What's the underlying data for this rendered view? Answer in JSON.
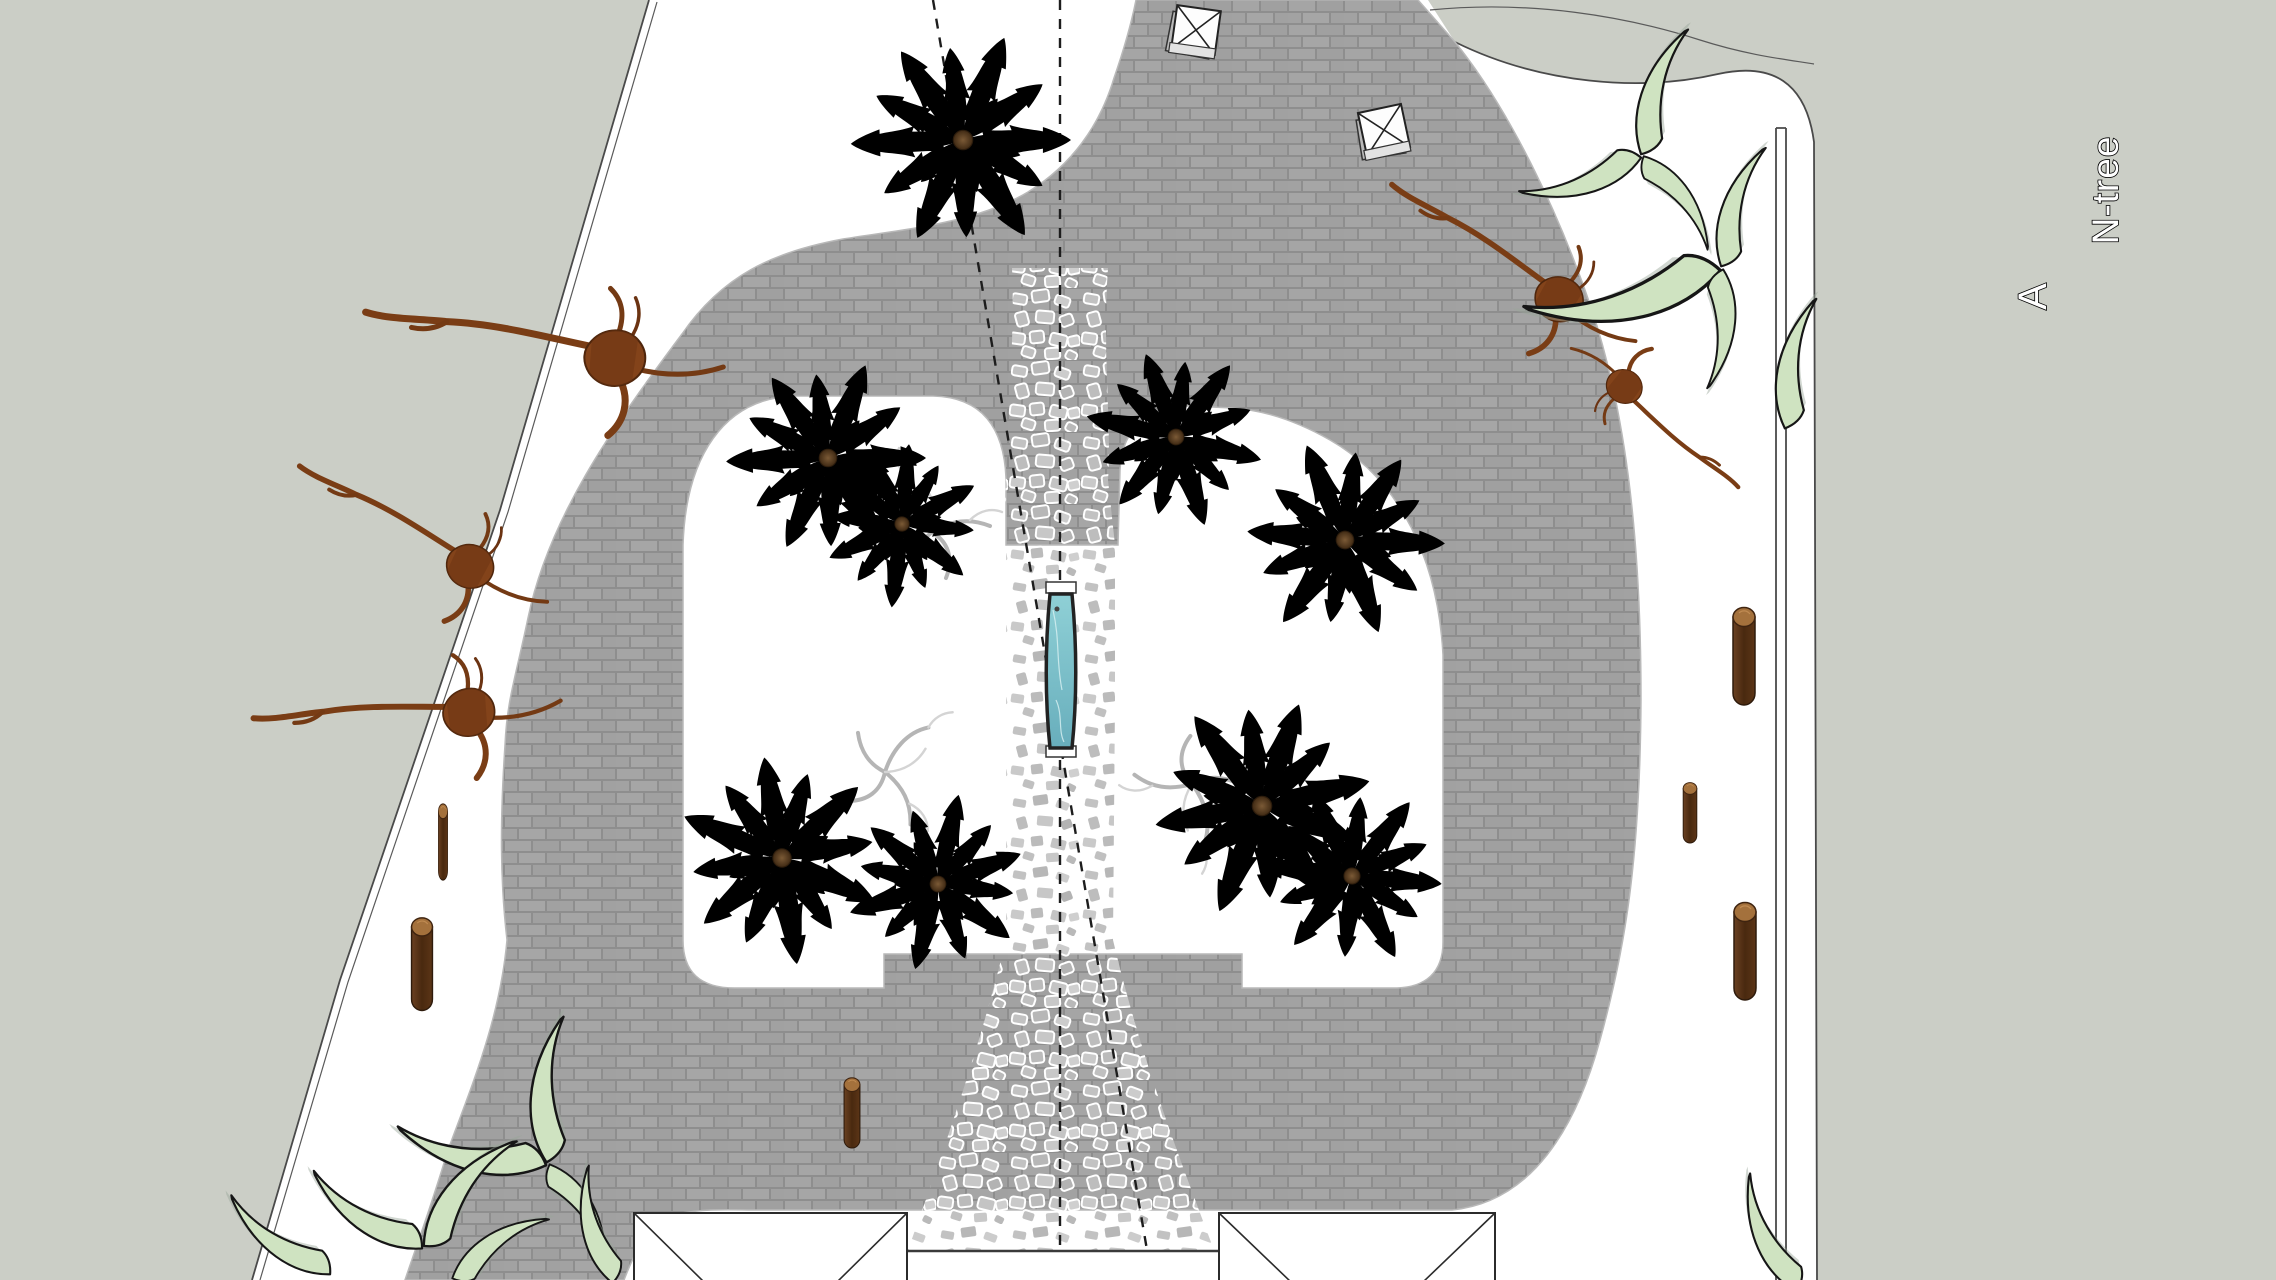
{
  "labels": {
    "north_note": "N-tree",
    "section_label": "A"
  },
  "colors": {
    "background_gray": "#cbcec6",
    "site_white": "#ffffff",
    "brick_fill": "#a3a3a3",
    "brick_grout": "#8e8e8e",
    "gravel_stone": "#c5c5c5",
    "water_teal": "#7ec3cc",
    "water_frame": "#222222",
    "palm_bright_green": "#6f9e48",
    "palm_dark_green": "#2f5529",
    "grass_sculpture_green": "#cfe3c1",
    "driftwood_brown": "#7c3f16",
    "log_brown": "#5e3a20",
    "line_color": "#4a4a4a"
  },
  "plan_items": [
    {
      "sym": "log",
      "name": "log-post",
      "t": "translate(1744 655)"
    },
    {
      "sym": "log",
      "name": "log-post",
      "t": "translate(1690 812) scale(0.62)"
    },
    {
      "sym": "log",
      "name": "log-post",
      "t": "translate(1745 950)"
    },
    {
      "sym": "log",
      "name": "log-post",
      "t": "translate(443 841) scale(0.42 0.78)"
    },
    {
      "sym": "log",
      "name": "log-post",
      "t": "translate(422 963) scale(0.95)"
    },
    {
      "sym": "log",
      "name": "log-post",
      "t": "translate(852 1112) scale(0.72)"
    },
    {
      "sym": "driftwood",
      "name": "driftwood-sculpture",
      "t": "translate(598 342) rotate(-6)"
    },
    {
      "sym": "driftwood",
      "name": "driftwood-sculpture",
      "t": "translate(462 550) rotate(14) scale(0.78)"
    },
    {
      "sym": "driftwood",
      "name": "driftwood-sculpture",
      "t": "translate(452 702) rotate(-18) scale(0.85)"
    },
    {
      "sym": "driftwood",
      "name": "driftwood-sculpture",
      "t": "translate(1552 282) rotate(18) scale(0.8)"
    },
    {
      "sym": "driftwood",
      "name": "driftwood-sculpture",
      "t": "translate(1628 400) rotate(205) scale(0.6)"
    },
    {
      "sym": "crescent",
      "name": "grass-sculpture",
      "t": "translate(1642 156) rotate(-118)"
    },
    {
      "sym": "crescent",
      "name": "grass-sculpture",
      "t": "translate(1642 156) rotate(116) scale(0.95)"
    },
    {
      "sym": "crescent",
      "name": "grass-sculpture",
      "t": "translate(1642 156) rotate(7) scale(0.85)"
    },
    {
      "sym": "crescent",
      "name": "grass-sculpture",
      "t": "translate(1722 268) rotate(-118) scale(0.95)"
    },
    {
      "sym": "crescent",
      "name": "grass-sculpture",
      "t": "translate(1722 268) rotate(121) scale(1.5)"
    },
    {
      "sym": "crescent",
      "name": "grass-sculpture",
      "t": "translate(1722 268) rotate(49) scale(0.9)"
    },
    {
      "sym": "crescent",
      "name": "grass-sculpture",
      "t": "translate(1786 430) rotate(-125)"
    },
    {
      "sym": "crescent",
      "name": "grass-sculpture",
      "t": "translate(548 1164) rotate(-132) scale(1.1)"
    },
    {
      "sym": "crescent",
      "name": "grass-sculpture",
      "t": "translate(548 1164) rotate(146) scale(1.15)"
    },
    {
      "sym": "crescent",
      "name": "grass-sculpture",
      "t": "translate(548 1164) rotate(12) scale(0.85)"
    },
    {
      "sym": "crescent",
      "name": "grass-sculpture",
      "t": "translate(424 1248) rotate(-97) scale(1.05)"
    },
    {
      "sym": "crescent",
      "name": "grass-sculpture",
      "t": "translate(424 1248) rotate(167)"
    },
    {
      "sym": "crescent",
      "name": "grass-sculpture",
      "t": "translate(452 1280) rotate(-80) scale(0.85)"
    },
    {
      "sym": "crescent",
      "name": "grass-sculpture",
      "t": "translate(332 1274) rotate(170) scale(0.95)"
    },
    {
      "sym": "crescent",
      "name": "grass-sculpture",
      "t": "translate(614 1284) rotate(-150) scale(0.9)"
    },
    {
      "sym": "crescent",
      "name": "grass-sculpture",
      "t": "translate(1798 1292) rotate(-160) scale(0.95)"
    },
    {
      "sym": "twig",
      "name": "dead-branch-sculpture",
      "t": "translate(932 532)"
    },
    {
      "sym": "twig",
      "name": "dead-branch-sculpture",
      "t": "translate(885 772) rotate(70)"
    },
    {
      "sym": "twig",
      "name": "dead-branch-sculpture",
      "t": "translate(1192 784) rotate(195)"
    },
    {
      "sym": "palm-b",
      "name": "palm-tree",
      "t": "translate(828 458) scale(0.98)"
    },
    {
      "sym": "palm-b",
      "name": "palm-tree",
      "t": "translate(902 524) scale(0.8) rotate(40)"
    },
    {
      "sym": "palm-b",
      "name": "palm-tree",
      "t": "translate(1176 437) scale(0.88) rotate(15)"
    },
    {
      "sym": "palm-b",
      "name": "palm-tree",
      "t": "translate(1345 540) scale(0.98) rotate(70)"
    },
    {
      "sym": "palm-b",
      "name": "palm-tree",
      "t": "translate(782 858) scale(1.02) rotate(25)"
    },
    {
      "sym": "palm-b",
      "name": "palm-tree",
      "t": "translate(938 884) scale(0.88) rotate(105)"
    },
    {
      "sym": "palm-b",
      "name": "palm-tree",
      "t": "translate(1262 806) scale(1.08) rotate(55)"
    },
    {
      "sym": "palm-b",
      "name": "palm-tree",
      "t": "translate(1352 876) scale(0.9) rotate(130)"
    },
    {
      "sym": "palm-d",
      "name": "fan-palm-tree",
      "t": "translate(963 140) scale(1.08)"
    },
    {
      "sym": "marker",
      "name": "skylight-marker",
      "t": "translate(1196 30) rotate(8)"
    },
    {
      "sym": "marker",
      "name": "skylight-marker",
      "t": "translate(1384 130) rotate(-12)"
    }
  ]
}
